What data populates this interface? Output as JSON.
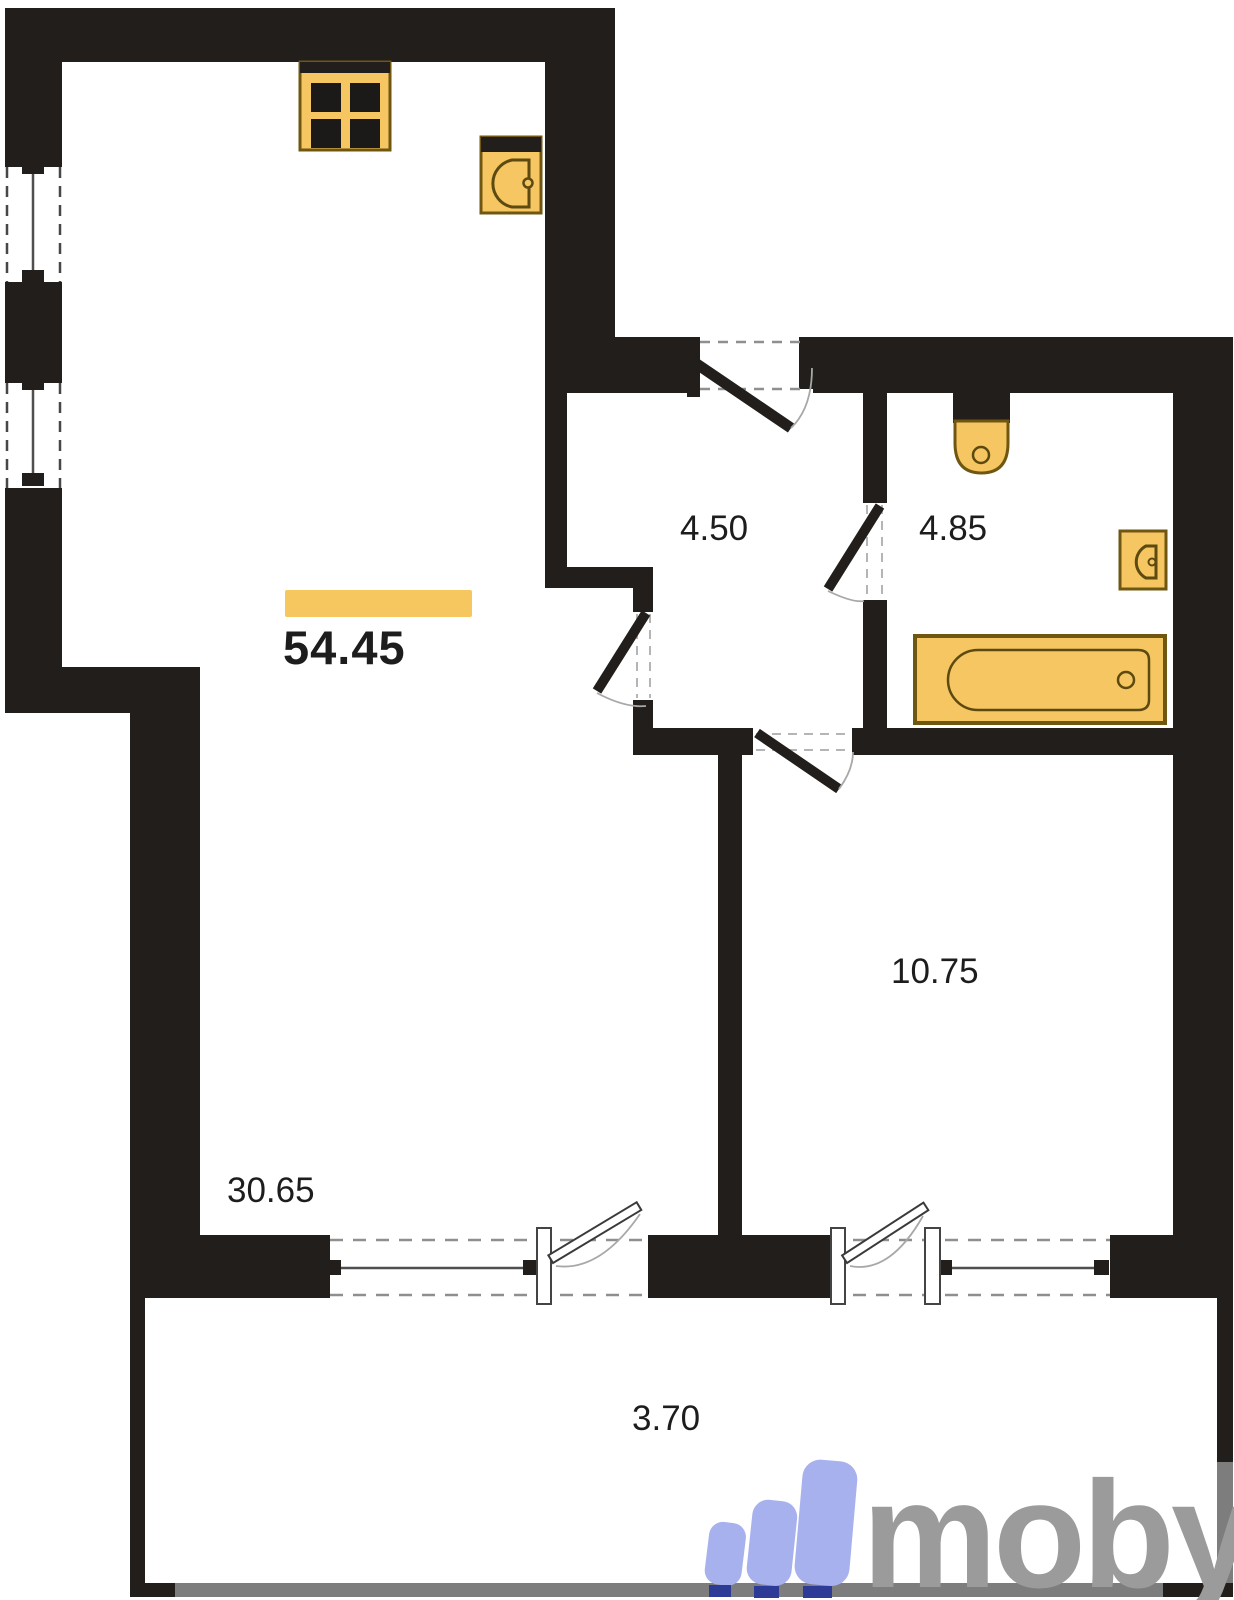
{
  "title": "Apartment floor plan",
  "total": {
    "area": "54.45"
  },
  "rooms": {
    "living_kitchen": {
      "area": "30.65"
    },
    "hallway": {
      "area": "4.50"
    },
    "bathroom": {
      "area": "4.85"
    },
    "bedroom": {
      "area": "10.75"
    },
    "balcony": {
      "area": "3.70"
    }
  },
  "fixtures": [
    "stove-icon",
    "kitchen-sink-icon",
    "toilet-icon",
    "bathroom-sink-icon",
    "bathtub-icon"
  ],
  "logo": {
    "text": "moby"
  },
  "colors": {
    "wall": "#211e1b",
    "fixture": "#f5c661",
    "fixture-stroke": "#6f5712",
    "fixture-inner": "#5c4a10",
    "accent": "#f6c75e",
    "dash-dark": "#474747",
    "dash-light": "#8f8f8f",
    "dash-faint": "#b5b5b5",
    "glass": "#4f4f4f",
    "balcony-gray": "#7d7d7d",
    "arc": "#a8a8a8",
    "logo-bars": "#a7b1ee",
    "logo-feet": "#2d3a96",
    "logo-text": "#9b9b9b",
    "label": "#1d1d1d"
  }
}
